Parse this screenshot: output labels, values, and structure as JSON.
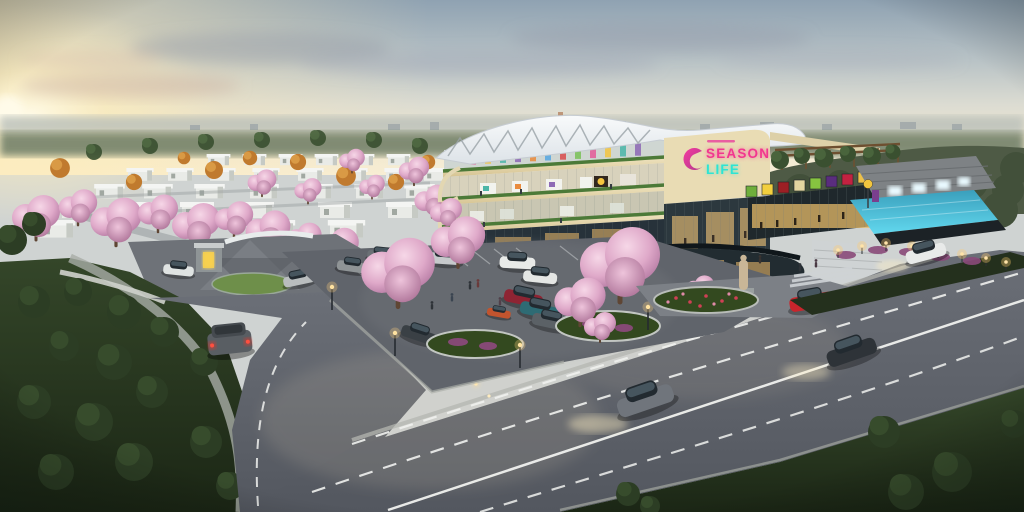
{
  "scene": {
    "description": "Aerial dusk architectural rendering of the Season Life community mall with rooftop swimming pool and tenant sign wall, a cherry-blossom lined parking court, a gated residential estate on the left, dark parkland in the foreground corners and a wide main road with passing cars",
    "time_of_day": "dusk"
  },
  "mall": {
    "sign": {
      "season": "SEASON",
      "life": "LIFE",
      "season_color": "#f2368f",
      "life_color": "#2ee4d3",
      "logo_color": "#e8359b"
    },
    "sign_tiles": [
      "#6fae3c",
      "#f2cf3e",
      "#9c1f24",
      "#e4d6a0",
      "#86c440",
      "#5a2d7e",
      "#c22240",
      "#ecc04a"
    ],
    "banner_colors": [
      "#e45d9a",
      "#f2c544",
      "#4db6a8",
      "#8e6bb5",
      "#e98c3f",
      "#5aa8e0",
      "#d94f4f",
      "#7cc25a",
      "#e45d9a",
      "#f2c544",
      "#4db6a8",
      "#8e6bb5"
    ]
  },
  "palette": {
    "sky_warm": "#f7eed6",
    "sky_cool": "#8fa2b2",
    "blossom_pink": "#dfa9c9",
    "pool_blue": "#62d8ee",
    "asphalt": "#60646b",
    "park_green": "#24301d",
    "facade_cream": "#e9dcb4"
  }
}
